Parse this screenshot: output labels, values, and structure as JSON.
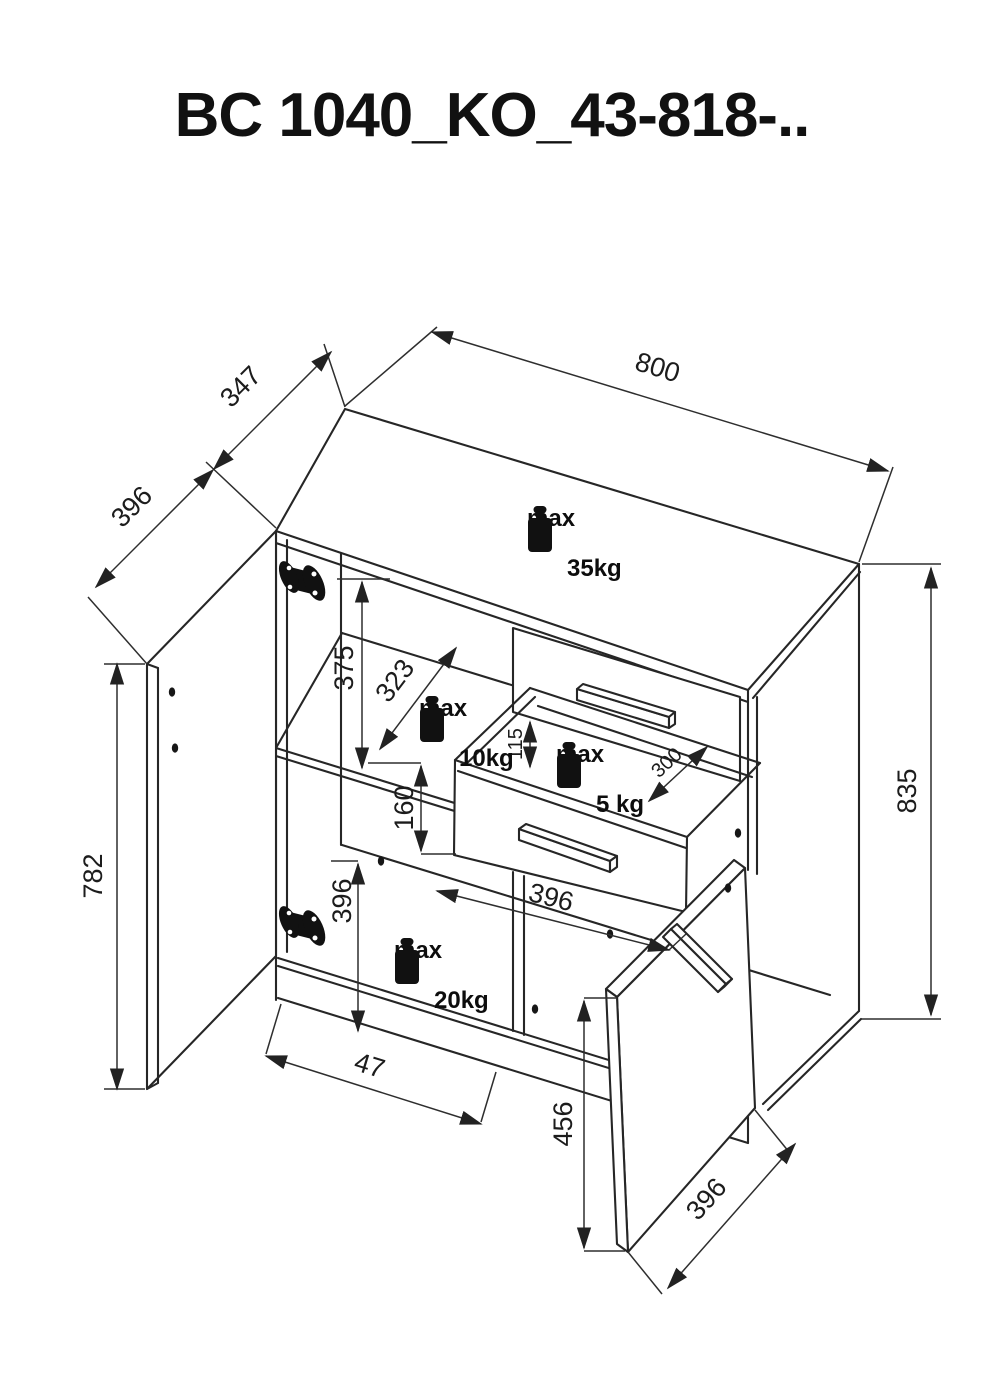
{
  "title": "BC 1040_KO_43-818-..",
  "dimensions": {
    "width_top": "800",
    "depth_top": "347",
    "door_left_width": "396",
    "door_left_height": "782",
    "height_right": "835",
    "upper_section_height": "375",
    "shelf_depth": "323",
    "drawer_inner_height": "115",
    "drawer_front_height": "160",
    "drawer_depth": "300",
    "lower_left_height": "396",
    "lower_width": "396",
    "foot_offset": "47",
    "door_right_height": "456",
    "door_right_width": "396"
  },
  "weights": {
    "top": {
      "label": "max",
      "value": "35kg"
    },
    "shelf": {
      "label": "max",
      "value": "10kg"
    },
    "drawer": {
      "label": "max",
      "value": "5 kg"
    },
    "bottom": {
      "label": "max",
      "value": "20kg"
    }
  }
}
